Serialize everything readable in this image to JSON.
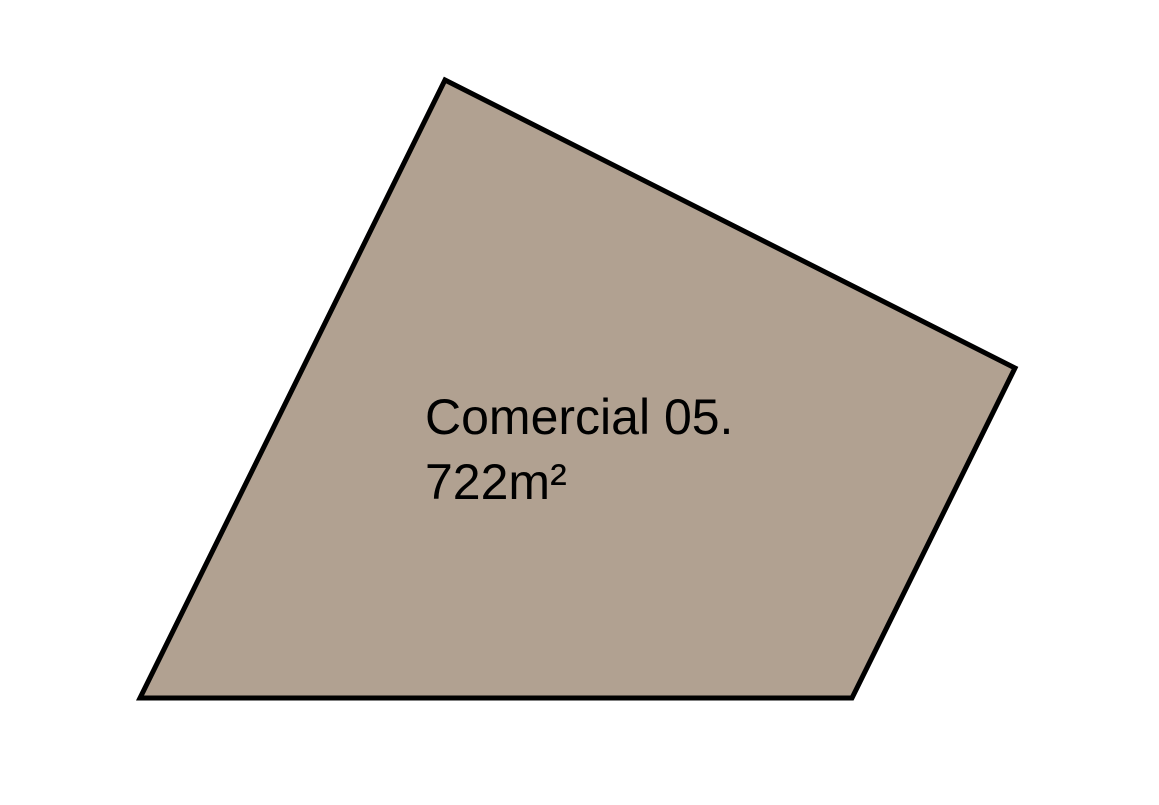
{
  "canvas": {
    "width": "1159",
    "height": "805",
    "background": "#ffffff"
  },
  "parcel": {
    "id": "commercial-05",
    "points": "445,80 1015,368 852,698 140,698",
    "fill": "#B1A191",
    "stroke": "#000000",
    "stroke_width": "5",
    "label": {
      "name": "Comercial 05.",
      "area": "722m²",
      "color": "#000000",
      "font_size": "50",
      "x": "425",
      "name_y": "434",
      "area_y": "499"
    }
  }
}
